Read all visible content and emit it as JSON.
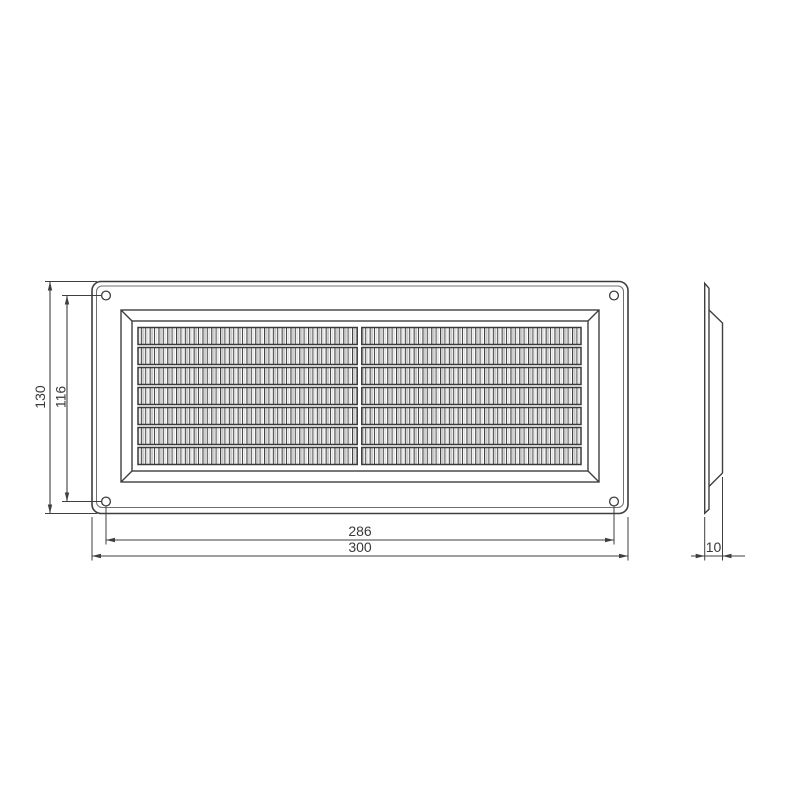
{
  "drawing": {
    "dim": {
      "overall_height": "130",
      "hole_spacing_vertical": "116",
      "hole_spacing_horizontal": "286",
      "overall_width": "300",
      "depth": "10"
    },
    "grille": {
      "slat_rows": 7,
      "slat_columns": 2,
      "corner_holes": 4
    },
    "colors": {
      "line": "#3f3f3f",
      "line_light": "#707070",
      "hatch_shade": "#c9c9c9",
      "background": "#ffffff"
    }
  }
}
